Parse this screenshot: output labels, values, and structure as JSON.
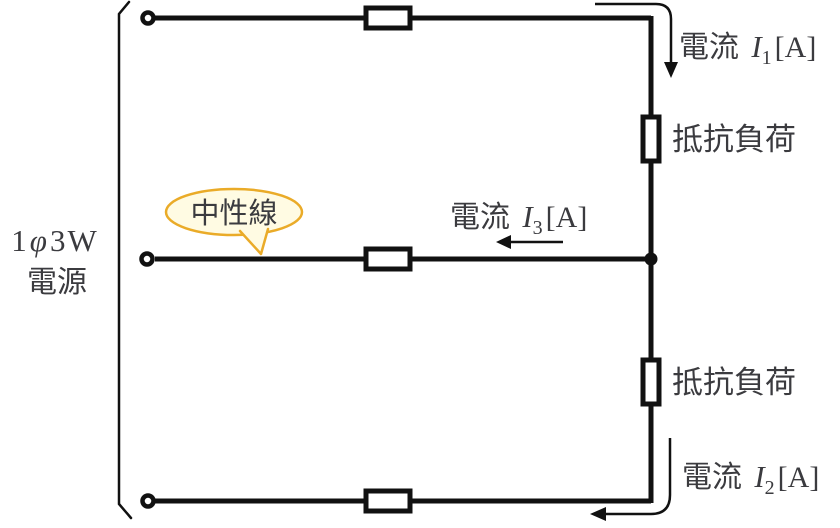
{
  "source": {
    "line1_parts": [
      "1",
      "φ",
      "3W"
    ],
    "line2": "電源"
  },
  "neutral_callout": {
    "label": "中性線",
    "fill": "#fffbe3",
    "border": "#eaab28"
  },
  "currents": {
    "i1": {
      "prefix": "電流 ",
      "symbol": "I",
      "sub": "1",
      "unit": "[A]"
    },
    "i2": {
      "prefix": "電流 ",
      "symbol": "I",
      "sub": "2",
      "unit": "[A]"
    },
    "i3": {
      "prefix": "電流 ",
      "symbol": "I",
      "sub": "3",
      "unit": "[A]"
    }
  },
  "loads": {
    "upper": "抵抗負荷",
    "lower": "抵抗負荷"
  },
  "colors": {
    "wire": "#111111",
    "text": "#3b3b3f",
    "red": "#f73333",
    "callout_fill": "#fffbe3",
    "callout_border": "#eaab28"
  }
}
